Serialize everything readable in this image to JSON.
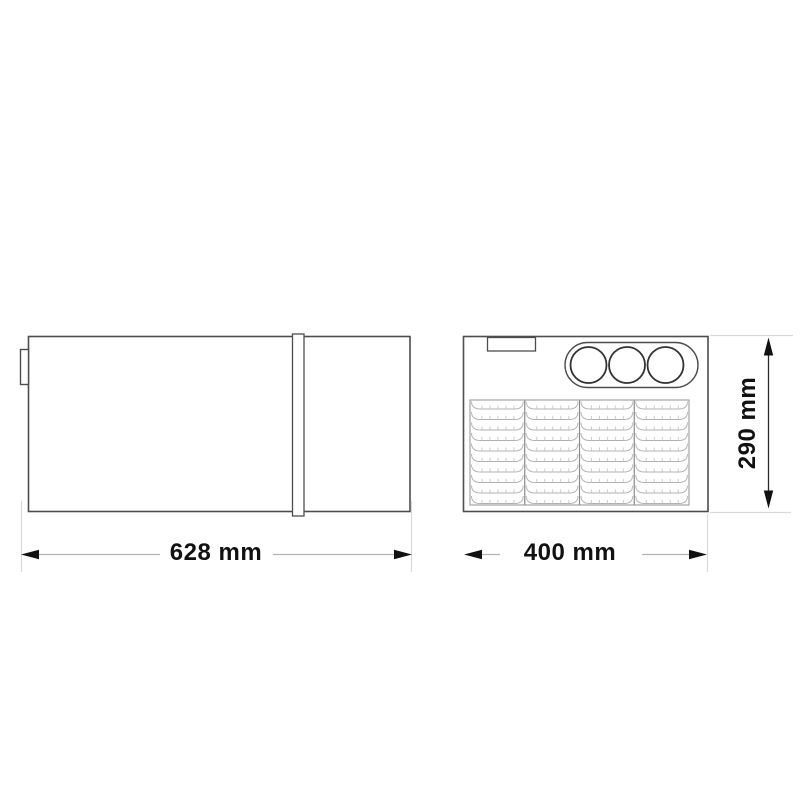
{
  "drawing": {
    "kind": "technical-dimension-drawing",
    "views": {
      "side_view": {
        "features": [
          "body",
          "mounting-tab",
          "divider-band"
        ]
      },
      "front_view": {
        "features": [
          "body",
          "vent-slot",
          "knob-panel",
          "ventilation-grille"
        ],
        "knob_count": 3,
        "grille_columns": 4,
        "grille_rows": 10
      }
    },
    "dimensions": {
      "length": "628 mm",
      "width": "400 mm",
      "height": "290 mm"
    },
    "colors": {
      "background": "#ffffff",
      "outline": "#4d4d4d",
      "grille_line": "#b0b0b0",
      "grille_separator": "#8a8a8a",
      "extension_line": "#d9d9d9",
      "dimension_line": "#b3b3b3",
      "arrow": "#111111",
      "label_text": "#111111"
    }
  }
}
